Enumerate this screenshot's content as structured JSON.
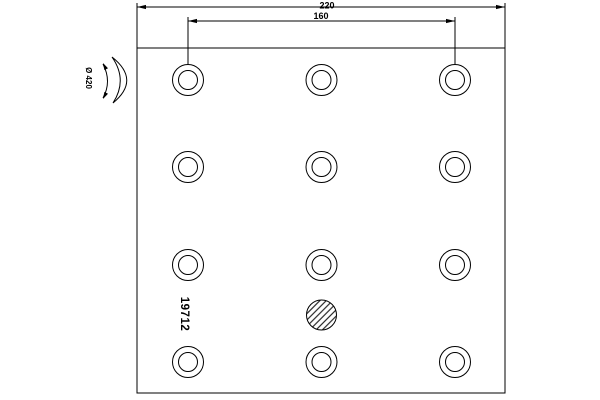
{
  "drawing": {
    "part_number": "19712",
    "dimensions": {
      "overall_width": "220",
      "rivet_hole_span": "160",
      "drum_diameter": "Ø 420"
    },
    "colors": {
      "line": "#000000",
      "background": "#ffffff"
    },
    "rivet_holes": {
      "columns_px": [
        188,
        321.5,
        455
      ],
      "rows_px": [
        80,
        167,
        265,
        362
      ],
      "outer_radius_px": 15.5,
      "inner_radius_px": 9.5
    },
    "wear_hole": {
      "cx_px": 321.5,
      "cy_px": 315,
      "radius_px": 15
    }
  }
}
